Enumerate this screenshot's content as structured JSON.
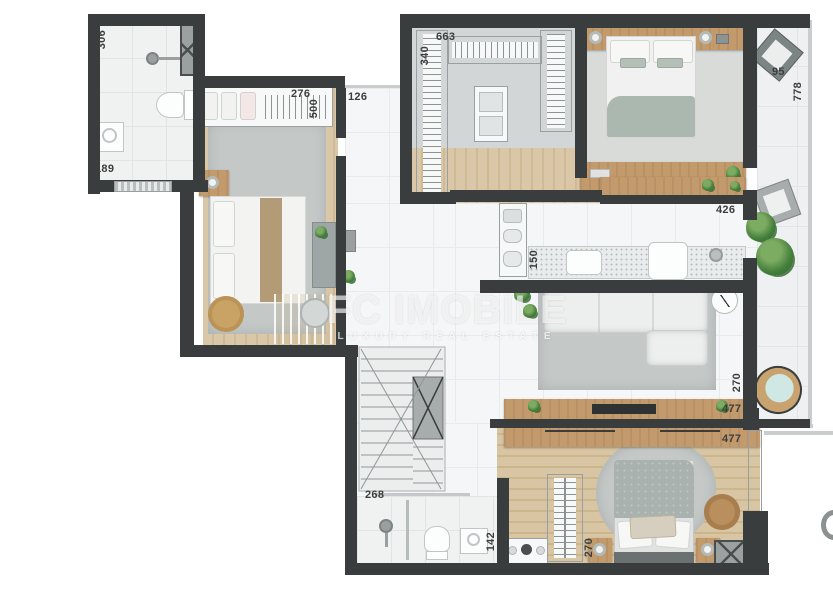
{
  "watermark": {
    "title": "FC IMOBILE",
    "subtitle": "LUXURY REAL ESTATE"
  },
  "dimensions": {
    "d306": "306",
    "d189": "189",
    "d276": "276",
    "d500": "500",
    "d126": "126",
    "d663": "663",
    "d340": "340",
    "d95": "95",
    "d778": "778",
    "d426": "426",
    "d150": "150",
    "d270a": "270",
    "d477a": "477",
    "d477b": "477",
    "d270b": "270",
    "d268": "268",
    "d142": "142"
  },
  "colors": {
    "wall": "#3a3d3d",
    "wood_floor": "#d8c5a4",
    "wood_furniture": "#c29a6b",
    "rug": "#c4c9c8",
    "plant_green": "#45803c",
    "tile": "#f0f2f2",
    "label_text": "#3c3e3e",
    "watermark_white": "rgba(255,255,255,0.62)"
  }
}
